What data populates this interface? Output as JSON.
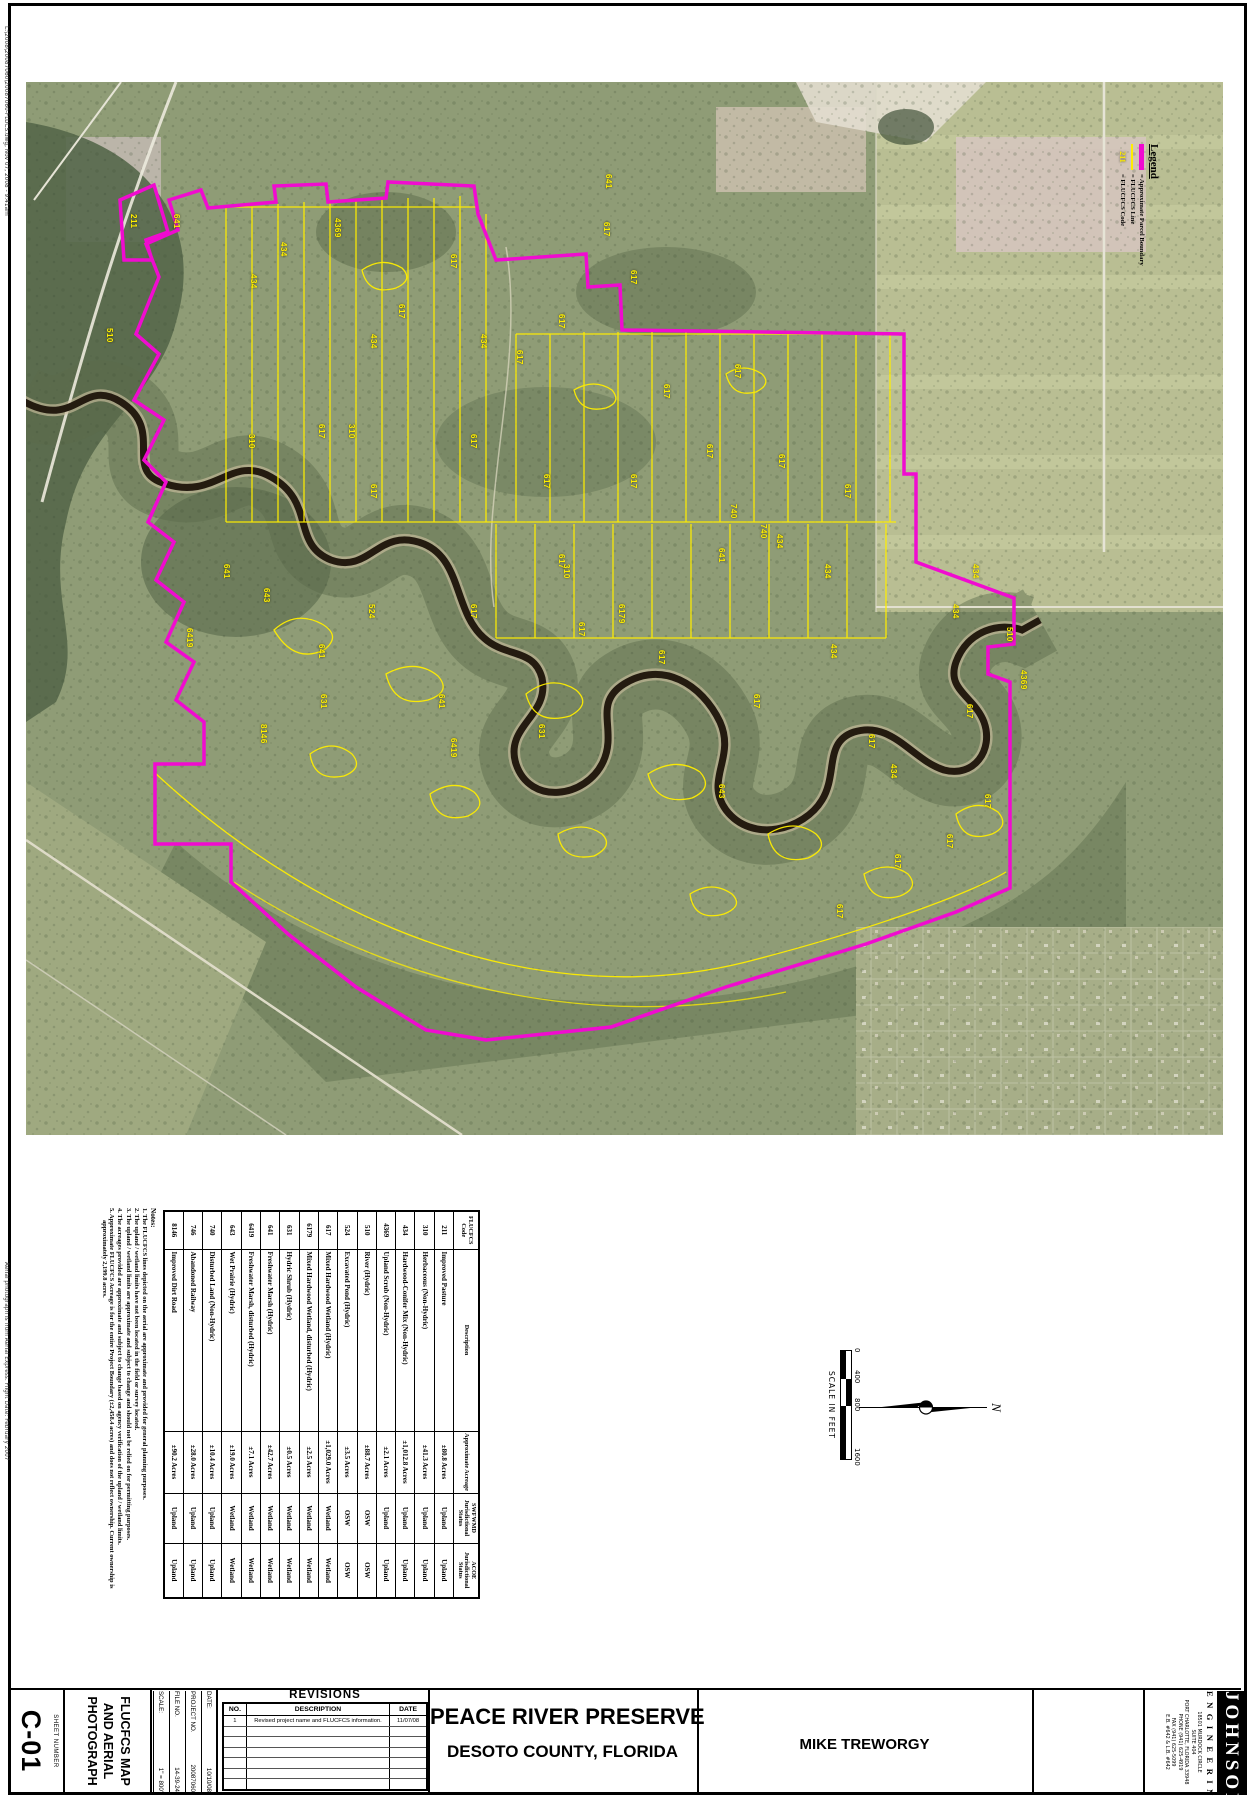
{
  "page": {
    "sheet_number": "C-01",
    "sheet_number_label": "SHEET NUMBER",
    "sheet_title_lines": [
      "FLUCFCS MAP",
      "AND AERIAL",
      "PHOTOGRAPH"
    ]
  },
  "edge_stamps": {
    "top_left": "L:\\2008\\20087060\\20087060-FLUCS.dwg,  Nov 07, 2008 - 9:41am",
    "bottom_left": "Aerial photograph is from Aerial Express.  Flight Date: February 2007"
  },
  "legend": {
    "title": "Legend",
    "items": [
      {
        "symbol": "parcel-boundary-line",
        "label": "= Approximate Parcel Boundary"
      },
      {
        "symbol": "flucfcs-line",
        "label": "= FLUCFCS Line"
      },
      {
        "symbol": "flucfcs-code",
        "symbol_text": "211",
        "label": "= FLUCFCS Code"
      }
    ],
    "colors": {
      "parcel_boundary": "#f00bd0",
      "flucfcs_line": "#ffee00"
    }
  },
  "flucfcs_table": {
    "headers": [
      "FLUCFCS Code",
      "Description",
      "Approximate Acreage",
      "SWFWMD Jurisdictional Status",
      "ACOE Jurisdictional Status"
    ],
    "rows": [
      [
        "211",
        "Improved Pasture",
        "±80.8 Acres",
        "Upland",
        "Upland"
      ],
      [
        "310",
        "Herbaceous (Non-Hydric)",
        "±41.3 Acres",
        "Upland",
        "Upland"
      ],
      [
        "434",
        "Hardwood-Conifer Mix (Non-Hydric)",
        "±1,012.8 Acres",
        "Upland",
        "Upland"
      ],
      [
        "4369",
        "Upland Scrub (Non-Hydric)",
        "±2.1 Acres",
        "Upland",
        "Upland"
      ],
      [
        "510",
        "River (Hydric)",
        "±88.7 Acres",
        "OSW",
        "OSW"
      ],
      [
        "524",
        "Excavated Pond (Hydric)",
        "±3.5 Acres",
        "OSW",
        "OSW"
      ],
      [
        "617",
        "Mixed Hardwood Wetland (Hydric)",
        "±1,029.0 Acres",
        "Wetland",
        "Wetland"
      ],
      [
        "6179",
        "Mixed Hardwood Wetland, disturbed (Hydric)",
        "±2.5 Acres",
        "Wetland",
        "Wetland"
      ],
      [
        "631",
        "Hydric Shrub (Hydric)",
        "±0.5 Acres",
        "Wetland",
        "Wetland"
      ],
      [
        "641",
        "Freshwater Marsh (Hydric)",
        "±42.7 Acres",
        "Wetland",
        "Wetland"
      ],
      [
        "6419",
        "Freshwater Marsh, disturbed (Hydric)",
        "±7.1 Acres",
        "Wetland",
        "Wetland"
      ],
      [
        "643",
        "Wet Prairie (Hydric)",
        "±19.0 Acres",
        "Wetland",
        "Wetland"
      ],
      [
        "740",
        "Disturbed Land (Non-Hydric)",
        "±10.4 Acres",
        "Upland",
        "Upland"
      ],
      [
        "746",
        "Abandoned Railway",
        "±28.0 Acres",
        "Upland",
        "Upland"
      ],
      [
        "8146",
        "Improved Dirt Road",
        "±90.2 Acres",
        "Upland",
        "Upland"
      ]
    ]
  },
  "notes": {
    "title": "Notes:",
    "items": [
      "1.  The FLUCFCS lines depicted on the aerial are approximate and provided for general planning purposes.",
      "2.  The upland / wetland limits have not been located in the field or survey located.",
      "3.  The upland / wetland limits are approximate and subject to change and should not be relied on for permitting purposes.",
      "4.  The acreages provided are approximate and subject to change based on agency verification of the upland / wetland limits.",
      "5.  Approximate FLUCFCS Acreage is for the entire Project Boundary (±2,458.4 acres) and does not reflect ownership.  Current ownership is approximately 2,199.8 acres."
    ]
  },
  "scale_bar": {
    "labels": [
      "0",
      "400",
      "800",
      "1600"
    ],
    "caption": "SCALE IN FEET"
  },
  "north_arrow": {
    "label": "N"
  },
  "title_block": {
    "fields": [
      {
        "label": "DATE:",
        "value": "10/10/08"
      },
      {
        "label": "PROJECT NO.",
        "value": "20087060"
      },
      {
        "label": "FILE NO.",
        "value": "14-39-24"
      },
      {
        "label": "SCALE:",
        "value": "1\" = 800'"
      }
    ],
    "revisions": {
      "title": "REVISIONS",
      "columns": [
        "NO.",
        "DESCRIPTION",
        "DATE"
      ],
      "rows": [
        {
          "no": "1",
          "description": "Revised project name and FLUCFCS information.",
          "date": "11/07/08"
        }
      ],
      "empty_rows": 6
    },
    "project_title": "PEACE RIVER PRESERVE",
    "project_subtitle": "DESOTO COUNTY, FLORIDA",
    "client": "MIKE TREWORGY",
    "firm": {
      "name": "JOHNSON",
      "name2": "ENGINEERING",
      "address_lines": [
        "18501 MURDOCK CIRCLE",
        "SUITE 404",
        "PORT CHARLOTTE, FLORIDA 33948",
        "PHONE (941) 625-4919",
        "FAX (941) 625-5099",
        "E.B. #642 & L.B. #642"
      ]
    }
  },
  "map_labels": [
    {
      "c": "641",
      "x": 155,
      "y": 132
    },
    {
      "c": "211",
      "x": 112,
      "y": 132
    },
    {
      "c": "510",
      "x": 88,
      "y": 246
    },
    {
      "c": "434",
      "x": 232,
      "y": 192
    },
    {
      "c": "434",
      "x": 262,
      "y": 160
    },
    {
      "c": "4369",
      "x": 316,
      "y": 136
    },
    {
      "c": "617",
      "x": 432,
      "y": 172
    },
    {
      "c": "617",
      "x": 585,
      "y": 140
    },
    {
      "c": "641",
      "x": 587,
      "y": 92
    },
    {
      "c": "617",
      "x": 612,
      "y": 188
    },
    {
      "c": "617",
      "x": 540,
      "y": 232
    },
    {
      "c": "617",
      "x": 498,
      "y": 268
    },
    {
      "c": "434",
      "x": 352,
      "y": 252
    },
    {
      "c": "434",
      "x": 462,
      "y": 252
    },
    {
      "c": "617",
      "x": 380,
      "y": 222
    },
    {
      "c": "617",
      "x": 645,
      "y": 302
    },
    {
      "c": "617",
      "x": 716,
      "y": 282
    },
    {
      "c": "310",
      "x": 330,
      "y": 342
    },
    {
      "c": "310",
      "x": 230,
      "y": 352
    },
    {
      "c": "617",
      "x": 300,
      "y": 342
    },
    {
      "c": "617",
      "x": 452,
      "y": 352
    },
    {
      "c": "617",
      "x": 352,
      "y": 402
    },
    {
      "c": "617",
      "x": 525,
      "y": 392
    },
    {
      "c": "617",
      "x": 612,
      "y": 392
    },
    {
      "c": "617",
      "x": 688,
      "y": 362
    },
    {
      "c": "617",
      "x": 760,
      "y": 372
    },
    {
      "c": "617",
      "x": 826,
      "y": 402
    },
    {
      "c": "740",
      "x": 712,
      "y": 422
    },
    {
      "c": "740",
      "x": 742,
      "y": 442
    },
    {
      "c": "434",
      "x": 758,
      "y": 452
    },
    {
      "c": "434",
      "x": 806,
      "y": 482
    },
    {
      "c": "434",
      "x": 954,
      "y": 482
    },
    {
      "c": "434",
      "x": 934,
      "y": 522
    },
    {
      "c": "641",
      "x": 205,
      "y": 482
    },
    {
      "c": "641",
      "x": 700,
      "y": 466
    },
    {
      "c": "617",
      "x": 540,
      "y": 472
    },
    {
      "c": "617",
      "x": 452,
      "y": 522
    },
    {
      "c": "310",
      "x": 545,
      "y": 482
    },
    {
      "c": "524",
      "x": 350,
      "y": 522
    },
    {
      "c": "643",
      "x": 245,
      "y": 506
    },
    {
      "c": "6419",
      "x": 168,
      "y": 546
    },
    {
      "c": "617",
      "x": 560,
      "y": 540
    },
    {
      "c": "6179",
      "x": 600,
      "y": 522
    },
    {
      "c": "641",
      "x": 300,
      "y": 562
    },
    {
      "c": "434",
      "x": 812,
      "y": 562
    },
    {
      "c": "510",
      "x": 988,
      "y": 545
    },
    {
      "c": "4369",
      "x": 1002,
      "y": 588
    },
    {
      "c": "617",
      "x": 640,
      "y": 568
    },
    {
      "c": "631",
      "x": 520,
      "y": 642
    },
    {
      "c": "631",
      "x": 302,
      "y": 612
    },
    {
      "c": "641",
      "x": 420,
      "y": 612
    },
    {
      "c": "8146",
      "x": 242,
      "y": 642
    },
    {
      "c": "6419",
      "x": 432,
      "y": 656
    },
    {
      "c": "617",
      "x": 735,
      "y": 612
    },
    {
      "c": "434",
      "x": 872,
      "y": 682
    },
    {
      "c": "617",
      "x": 850,
      "y": 652
    },
    {
      "c": "617",
      "x": 948,
      "y": 622
    },
    {
      "c": "643",
      "x": 700,
      "y": 702
    },
    {
      "c": "617",
      "x": 966,
      "y": 712
    },
    {
      "c": "617",
      "x": 928,
      "y": 752
    },
    {
      "c": "617",
      "x": 876,
      "y": 772
    },
    {
      "c": "617",
      "x": 818,
      "y": 822
    }
  ]
}
